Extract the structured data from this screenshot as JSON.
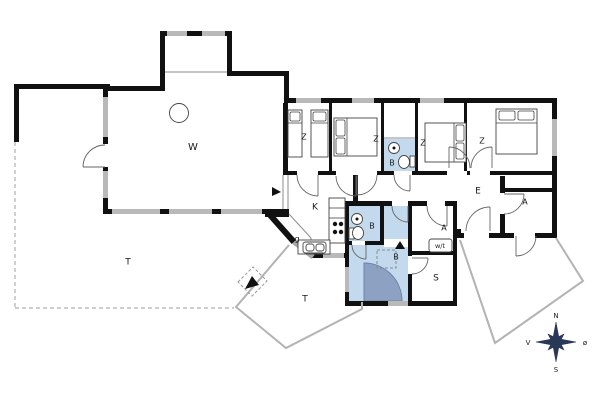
{
  "title": "Holiday house floor plan",
  "colors": {
    "wall": "#111111",
    "window": "#b9b9b9",
    "glass": "#a8a8a8",
    "blue": "#c3d9ee",
    "blue_dark": "#8da2c2",
    "blue_dark_edge": "#6e82a5",
    "furniture_line": "#444444",
    "arc_line": "#666666",
    "terrace_line": "#b3b3b3",
    "dash_line": "#b0b0b0",
    "label": "#1a1a1a",
    "compass": "#2a3857"
  },
  "rooms": [
    {
      "id": "living-room",
      "label": "W",
      "x": 193,
      "y": 147,
      "fs": 10
    },
    {
      "id": "terrace-west",
      "label": "T",
      "x": 128,
      "y": 262,
      "fs": 9
    },
    {
      "id": "terrace-south",
      "label": "T",
      "x": 305,
      "y": 299,
      "fs": 9
    },
    {
      "id": "bedroom-1",
      "label": "Z",
      "x": 304,
      "y": 137,
      "fs": 8
    },
    {
      "id": "bedroom-2",
      "label": "Z",
      "x": 376,
      "y": 139,
      "fs": 8
    },
    {
      "id": "bedroom-3",
      "label": "Z",
      "x": 423,
      "y": 143,
      "fs": 8
    },
    {
      "id": "bedroom-4",
      "label": "Z",
      "x": 482,
      "y": 141,
      "fs": 8
    },
    {
      "id": "bath-north",
      "label": "B",
      "x": 392,
      "y": 163,
      "fs": 8
    },
    {
      "id": "kitchen",
      "label": "K",
      "x": 315,
      "y": 207,
      "fs": 9
    },
    {
      "id": "entry-closet",
      "label": "g",
      "x": 297,
      "y": 239,
      "fs": 8
    },
    {
      "id": "bath-small",
      "label": "B",
      "x": 372,
      "y": 226,
      "fs": 8
    },
    {
      "id": "bath-big",
      "label": "B",
      "x": 396,
      "y": 257,
      "fs": 8
    },
    {
      "id": "hallway",
      "label": "E",
      "x": 478,
      "y": 191,
      "fs": 9
    },
    {
      "id": "storage-small",
      "label": "A",
      "x": 444,
      "y": 228,
      "fs": 8
    },
    {
      "id": "washer-dryer",
      "label": "w/t",
      "x": 440,
      "y": 246,
      "fs": 6.5
    },
    {
      "id": "sauna-room",
      "label": "S",
      "x": 436,
      "y": 278,
      "fs": 9
    },
    {
      "id": "annex",
      "label": "A",
      "x": 525,
      "y": 202,
      "fs": 8
    }
  ],
  "compass": {
    "center_x": 556,
    "center_y": 342,
    "main_points": "556,322 559.2,338.8 576,342 559.2,345.2 556,362 552.8,345.2 536,342 552.8,338.8",
    "diag_points": "564.1,333.9 560,342 564.1,350.1 556,346 547.9,350.1 552,342 547.9,333.9 556,338",
    "labels": [
      {
        "id": "north",
        "text": "N",
        "x": 556,
        "y": 316
      },
      {
        "id": "south",
        "text": "S",
        "x": 556,
        "y": 370
      },
      {
        "id": "west",
        "text": "V",
        "x": 528,
        "y": 343
      },
      {
        "id": "east",
        "text": "ø",
        "x": 585,
        "y": 343
      }
    ]
  },
  "geometry": {
    "blue_rects": [
      [
        384,
        139,
        31,
        32
      ],
      [
        349,
        206,
        31,
        35
      ],
      [
        384,
        206,
        24,
        35
      ],
      [
        349,
        245,
        59,
        56
      ]
    ],
    "quarter_path": "M364,301 L364,263 A38,38 0 0 1 402,301 Z",
    "white_steps": [
      [
        384,
        239,
        24,
        8
      ]
    ],
    "walls": [
      [
        14,
        84,
        96,
        5
      ],
      [
        14,
        84,
        5,
        58
      ],
      [
        103,
        86,
        5,
        127
      ],
      [
        103,
        86,
        62,
        5
      ],
      [
        160,
        31,
        5,
        60
      ],
      [
        160,
        31,
        72,
        5
      ],
      [
        227,
        31,
        5,
        45
      ],
      [
        227,
        71,
        62,
        5
      ],
      [
        284,
        71,
        5,
        32
      ],
      [
        284,
        98,
        273,
        5
      ],
      [
        552,
        98,
        5,
        140
      ],
      [
        283,
        103,
        5,
        72
      ],
      [
        265,
        209,
        24,
        8
      ],
      [
        103,
        209,
        186,
        5
      ],
      [
        284,
        171,
        273,
        4
      ],
      [
        500,
        188,
        57,
        4
      ],
      [
        500,
        176,
        5,
        57
      ],
      [
        457,
        233,
        100,
        5
      ],
      [
        453,
        229,
        8,
        9
      ],
      [
        310,
        253,
        36,
        5
      ],
      [
        345,
        201,
        4,
        105
      ],
      [
        345,
        201,
        47,
        5
      ],
      [
        408,
        201,
        19,
        5
      ],
      [
        445,
        201,
        12,
        5
      ],
      [
        453,
        201,
        4,
        105
      ],
      [
        408,
        201,
        4,
        104
      ],
      [
        345,
        301,
        112,
        5
      ],
      [
        408,
        251,
        49,
        4
      ],
      [
        380,
        206,
        4,
        35
      ],
      [
        345,
        241,
        39,
        4
      ],
      [
        353,
        175,
        5,
        31
      ],
      [
        329,
        102,
        3,
        70
      ],
      [
        381,
        102,
        3,
        70
      ],
      [
        415,
        102,
        3,
        70
      ],
      [
        464,
        102,
        3,
        70
      ]
    ],
    "gaps": [
      [
        103,
        144,
        5,
        23
      ],
      [
        297,
        171,
        21,
        4
      ],
      [
        336,
        171,
        20,
        4
      ],
      [
        356,
        171,
        21,
        4
      ],
      [
        394,
        171,
        18,
        4
      ],
      [
        447,
        171,
        20,
        4
      ],
      [
        470,
        171,
        20,
        4
      ],
      [
        392,
        201,
        16,
        5
      ],
      [
        427,
        201,
        18,
        5
      ],
      [
        500,
        193,
        5,
        21
      ],
      [
        464,
        233,
        25,
        5
      ],
      [
        514,
        233,
        21,
        5
      ],
      [
        352,
        241,
        13,
        4
      ],
      [
        408,
        256,
        4,
        18
      ]
    ],
    "windows": [
      [
        167,
        31,
        20,
        5
      ],
      [
        202,
        31,
        23,
        5
      ],
      [
        103,
        97,
        5,
        40
      ],
      [
        103,
        171,
        5,
        27
      ],
      [
        112,
        209,
        48,
        5
      ],
      [
        169,
        209,
        43,
        5
      ],
      [
        221,
        209,
        41,
        5
      ],
      [
        296,
        98,
        25,
        5
      ],
      [
        352,
        98,
        22,
        5
      ],
      [
        420,
        98,
        24,
        5
      ],
      [
        552,
        119,
        5,
        37
      ],
      [
        323,
        253,
        21,
        5
      ],
      [
        345,
        267,
        4,
        25
      ],
      [
        388,
        301,
        20,
        5
      ]
    ],
    "black_diagonals": [
      [
        270,
        215,
        294,
        242
      ]
    ],
    "glass_diagonals": [
      [
        294,
        242,
        313,
        257
      ]
    ],
    "thin_lines": [
      [
        165,
        72,
        227,
        72
      ],
      [
        283,
        175,
        283,
        209
      ],
      [
        288,
        175,
        288,
        209
      ],
      [
        289,
        214,
        311,
        238
      ],
      [
        311,
        238,
        311,
        253
      ],
      [
        384,
        138,
        415,
        138
      ]
    ],
    "gray_polylines": [
      "289,245 236,307 286,348 362,309 362,302",
      "460,240 495,343 583,281 556,238"
    ],
    "dashed_lines": [
      [
        15,
        142,
        15,
        308
      ],
      [
        15,
        308,
        234,
        308
      ]
    ],
    "dashed_polygons": [
      "238,282 253,267 267,281 252,296"
    ],
    "dashed_rects": [
      [
        377,
        250,
        19,
        18
      ]
    ],
    "arcs": [
      "M105,145 A22,22 0 0 0 83,167",
      "M297,175 A21,21 0 0 0 318,196",
      "M377,175 A20,20 0 0 1 357,195",
      "M394,175 A16,16 0 0 0 410,191",
      "M470,168 A21,21 0 0 0 449,147",
      "M471,168 A21,21 0 0 1 492,147",
      "M336,176 A20,20 0 0 0 356,196",
      "M392,206 A16,16 0 0 0 408,222",
      "M427,206 A20,20 0 0 0 447,226",
      "M352,245 A14,14 0 0 0 366,259",
      "M412,274 A16,16 0 0 0 428,258",
      "M504,214 A20,20 0 0 0 524,194",
      "M536,236 A20,20 0 0 1 516,256",
      "M466,231 A24,24 0 0 1 490,207"
    ],
    "leaves": [
      [
        105,
        167,
        83,
        167
      ],
      [
        318,
        175,
        318,
        196
      ],
      [
        357,
        175,
        357,
        195
      ],
      [
        410,
        175,
        410,
        191
      ],
      [
        449,
        168,
        449,
        147
      ],
      [
        492,
        168,
        492,
        147
      ],
      [
        356,
        176,
        356,
        196
      ],
      [
        408,
        206,
        408,
        222
      ],
      [
        447,
        206,
        447,
        226
      ],
      [
        366,
        245,
        366,
        259
      ],
      [
        412,
        258,
        428,
        258
      ],
      [
        504,
        194,
        524,
        194
      ],
      [
        516,
        236,
        516,
        256
      ],
      [
        490,
        231,
        490,
        207
      ]
    ],
    "arrows": [
      "272,187 272,196 281,192",
      "395,249 405,249 400,241",
      "245,289 252,276 259,285"
    ],
    "furniture": {
      "rects": [
        [
          288,
          110,
          14,
          47
        ],
        [
          311,
          110,
          17,
          47
        ],
        [
          334,
          118,
          43,
          38
        ],
        [
          425,
          123,
          41,
          39
        ],
        [
          496,
          109,
          41,
          45
        ],
        [
          329,
          198,
          16,
          45
        ],
        [
          298,
          240,
          32,
          14
        ],
        [
          410,
          156,
          5,
          11
        ],
        [
          349,
          228,
          5,
          11
        ]
      ],
      "pillows": [
        [
          290,
          112,
          10,
          9
        ],
        [
          313,
          112,
          13,
          9
        ],
        [
          336,
          120,
          9,
          16
        ],
        [
          336,
          138,
          9,
          16
        ],
        [
          456,
          125,
          8,
          16
        ],
        [
          456,
          143,
          8,
          16
        ],
        [
          499,
          111,
          16,
          9
        ],
        [
          518,
          111,
          16,
          9
        ]
      ],
      "round_rects": [
        [
          303,
          242,
          23,
          11
        ],
        [
          306,
          244,
          8,
          7
        ],
        [
          316,
          244,
          8,
          7
        ],
        [
          429,
          239,
          23,
          13
        ]
      ],
      "lines": [
        [
          347,
          118,
          347,
          156
        ],
        [
          454,
          123,
          454,
          162
        ],
        [
          496,
          123,
          537,
          123
        ],
        [
          288,
          123,
          302,
          123
        ],
        [
          311,
          123,
          328,
          123
        ],
        [
          329,
          208,
          345,
          208
        ],
        [
          329,
          218,
          345,
          218
        ]
      ],
      "circles": [
        [
          179,
          113,
          9.5
        ],
        [
          394,
          148,
          5.5
        ],
        [
          357,
          219,
          5.5
        ]
      ],
      "dots": [
        [
          335,
          224,
          2.2
        ],
        [
          341,
          224,
          2.2
        ],
        [
          335,
          232,
          2.2
        ],
        [
          341,
          232,
          2.2
        ],
        [
          394,
          148,
          1.5
        ],
        [
          357,
          219,
          1.5
        ]
      ],
      "ellipses": [
        [
          404,
          162,
          5.5,
          6.5
        ],
        [
          358,
          233,
          5.5,
          6.5
        ]
      ]
    }
  }
}
